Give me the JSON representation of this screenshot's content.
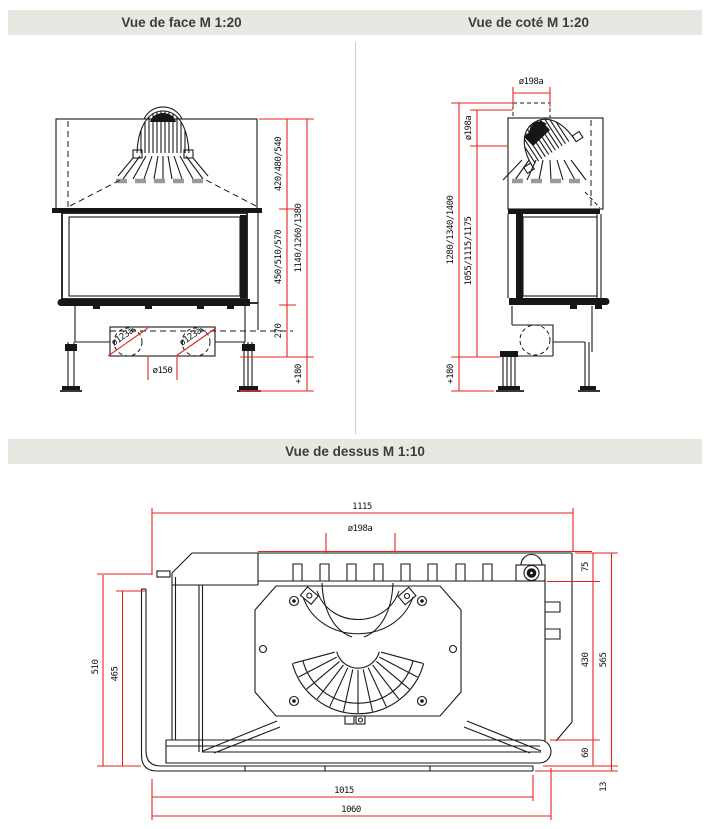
{
  "titles": {
    "front": "Vue de face M 1:20",
    "side": "Vue de coté M 1:20",
    "top": "Vue de dessus M 1:10"
  },
  "colors": {
    "accent_red": "#e4251f",
    "line_black": "#1a1a1a",
    "titlebar_bg": "#e9e7e2",
    "title_text": "#3e3c39",
    "dash_gray": "#9a9a9a"
  },
  "front_view": {
    "dims": {
      "seg_top": "420/480/540",
      "seg_mid": "450/510/570",
      "seg_low": "270",
      "overall": "1140/1260/1380",
      "feet": "+180",
      "outlet_left": "ø123a",
      "outlet_right": "ø123a",
      "base_diameter": "ø150"
    }
  },
  "side_view": {
    "dims": {
      "flue_dia_top": "ø198a",
      "flue_dia_side": "ø198a",
      "height_inner": "1055/1115/1175",
      "height_outer": "1280/1340/1400",
      "feet": "+180"
    }
  },
  "top_view": {
    "dims": {
      "overall_width": "1115",
      "flue_dia": "ø198a",
      "top_offset": "75",
      "side_depth": "430",
      "overall_depth": "565",
      "front_strip": "60",
      "glass_thickness": "13",
      "depth_glass": "510",
      "depth_inner": "465",
      "glass_width": "1015",
      "front_width": "1060"
    }
  }
}
